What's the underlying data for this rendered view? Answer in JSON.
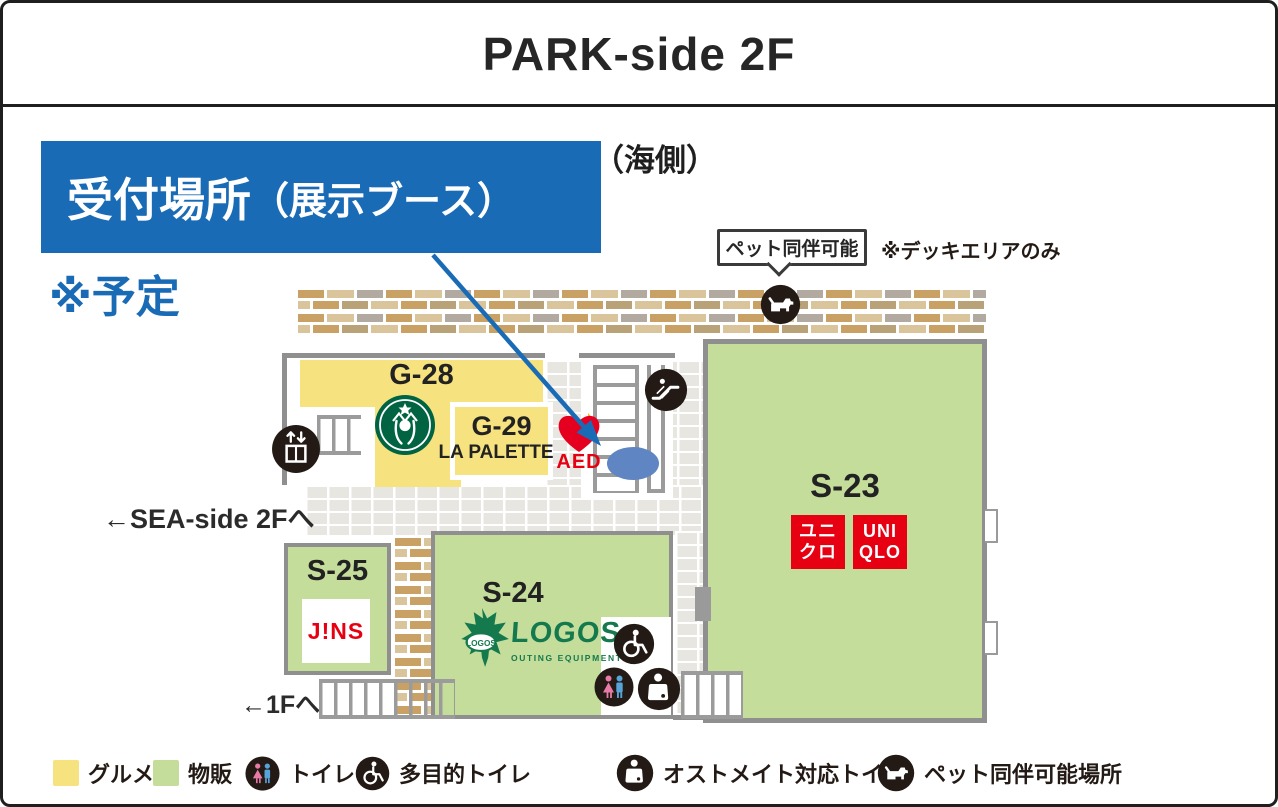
{
  "title": "PARK-side 2F",
  "callout": {
    "main": "受付場所",
    "paren": "（展示ブース）",
    "note": "※予定"
  },
  "sea_side_label": "（海側）",
  "pet_bubble": {
    "label": "ペット同伴可能",
    "note": "※デッキエリアのみ"
  },
  "nav": {
    "sea_side_exit": "←SEA-side 2Fへ",
    "first_floor_exit": "←1Fへ"
  },
  "aed_label": "AED",
  "shops": {
    "g28": {
      "id": "G-28",
      "logo": "starbucks-logo"
    },
    "g29": {
      "id": "G-29",
      "name": "LA PALETTE"
    },
    "s23": {
      "id": "S-23",
      "uniqlo_jp": [
        "ユニ",
        "クロ"
      ],
      "uniqlo_en": [
        "UNI",
        "QLO"
      ]
    },
    "s24": {
      "id": "S-24",
      "brand": "LOGOS",
      "brand_sub": "OUTING EQUIPMENT"
    },
    "s25": {
      "id": "S-25",
      "brand": "J!NS"
    }
  },
  "legend": [
    {
      "label": "グルメ",
      "swatch": "#f6e27e"
    },
    {
      "label": "物販",
      "swatch": "#c5dd9a"
    },
    {
      "label": "トイレ"
    },
    {
      "label": "多目的トイレ"
    },
    {
      "label": "オストメイト対応トイレ"
    },
    {
      "label": "ペット同伴可能場所"
    }
  ],
  "colors": {
    "accent-blue": "#1a6bb5",
    "gourmet-yellow": "#f6e27e",
    "retail-green": "#c5dd9a",
    "brand-red": "#e60012",
    "wall-gray": "#8f8f8f",
    "icon-black": "#231a15",
    "starbucks-green": "#006443",
    "logos-green": "#15794e",
    "marker-blue": "#5f86c2"
  }
}
